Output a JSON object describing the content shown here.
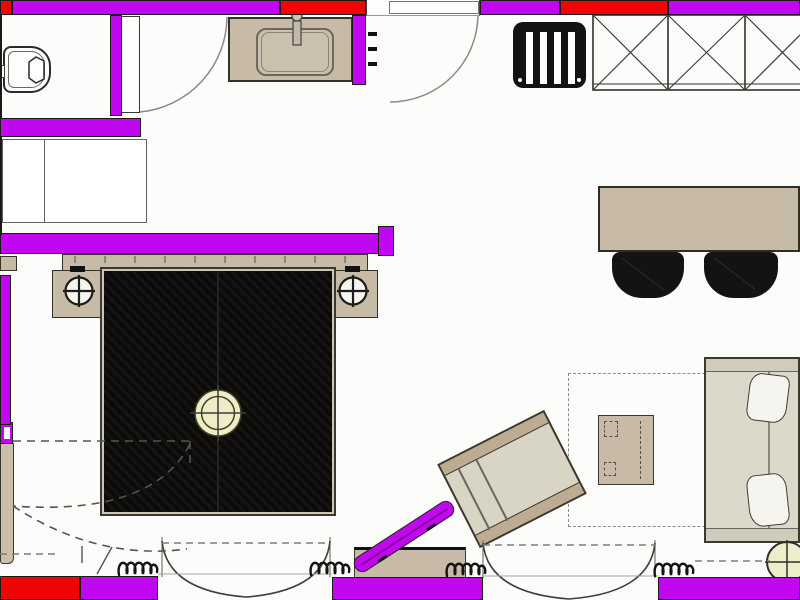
{
  "plan": {
    "kind": "hotel-guestroom-floor-plan",
    "colors": {
      "wall_highlight": "#c107f0",
      "wall_red": "#ef0505",
      "outline_dark": "#1c1a17",
      "line_gray": "#85837d",
      "dash_gray": "#7d7d78",
      "wood_tan": "#c7bba7",
      "wood_tan_dark": "#bbac92",
      "upholstery_light": "#dcd9ca",
      "seat_cream": "#d8d5c5",
      "bed_black": "#0c0b09",
      "chair_black": "#141311",
      "light_cream": "#efecca",
      "pillow_white": "#f5f4ef",
      "door_white": "#fdfdfc",
      "floor_white": "#fcfcfa"
    },
    "symbols": [
      {
        "id": "toilet",
        "label": "toilet"
      },
      {
        "id": "bathroom-door",
        "label": "hinged door with swing arc"
      },
      {
        "id": "vanity-counter",
        "label": "vanity counter with sink and faucet"
      },
      {
        "id": "towel-rail-ticks",
        "label": "towel rail marks"
      },
      {
        "id": "entry-door",
        "label": "entry door with swing arc"
      },
      {
        "id": "slatted-bench",
        "label": "black slatted luggage bench"
      },
      {
        "id": "wardrobe",
        "label": "wardrobe with X-hatched sections"
      },
      {
        "id": "service-shafts",
        "label": "closet / shaft rectangles"
      },
      {
        "id": "double-bed",
        "label": "double bed with black mattress hatch"
      },
      {
        "id": "headboard",
        "label": "headboard panel"
      },
      {
        "id": "nightstand-left",
        "label": "left nightstand with lamp symbol"
      },
      {
        "id": "nightstand-right",
        "label": "right nightstand with lamp symbol"
      },
      {
        "id": "ceiling-light",
        "label": "ceiling light crosshair circle"
      },
      {
        "id": "dining-table",
        "label": "desk / dining table"
      },
      {
        "id": "dining-chairs",
        "label": "two black chairs"
      },
      {
        "id": "lounge-chair",
        "label": "rotated lounge chair"
      },
      {
        "id": "pouf-table",
        "label": "square pouf side table"
      },
      {
        "id": "sofa-daybed",
        "label": "sofa / daybed with two pillows"
      },
      {
        "id": "round-side-table",
        "label": "round side table with crosshair"
      },
      {
        "id": "area-rug",
        "label": "dashed rug outline"
      },
      {
        "id": "bench-seat",
        "label": "low bench at window"
      },
      {
        "id": "luggage-rack",
        "label": "folded magenta luggage rack on bench"
      },
      {
        "id": "curtain-squiggles",
        "label": "curtain / drape loop symbols"
      },
      {
        "id": "french-doors",
        "label": "double french door swing arcs"
      },
      {
        "id": "folding-door-dashed",
        "label": "dashed double swing door"
      },
      {
        "id": "highlighted-walls",
        "label": "magenta highlighted walls"
      },
      {
        "id": "accent-walls",
        "label": "red accent wall segments"
      }
    ]
  }
}
